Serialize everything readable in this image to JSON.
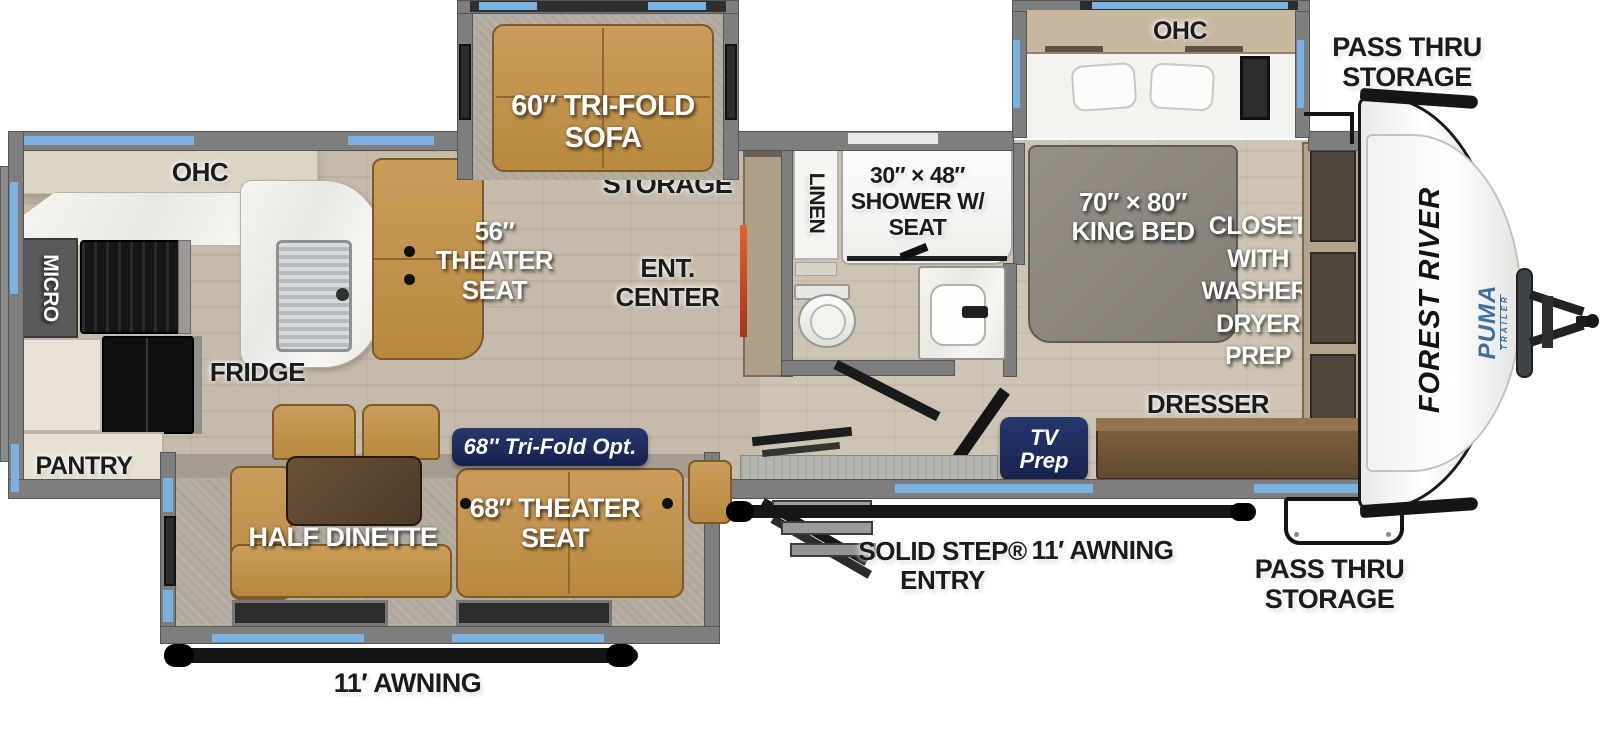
{
  "title": "Forest River Puma travel trailer floor plan",
  "colors": {
    "accent_blue": "#7cb2df",
    "badge_navy": "#1d2c5f",
    "puma_blue": "#3e6f9e",
    "furniture_tan": "#c49a55",
    "wall_gray": "#7e7e7e",
    "floor_tan": "#c6bbaa"
  },
  "front_cap": {
    "brand": "FOREST RIVER",
    "model": "PUMA",
    "model_sub": "TRAILER"
  },
  "exterior": {
    "pass_thru_top": {
      "l1": "PASS THRU",
      "l2": "STORAGE"
    },
    "pass_thru_bottom": {
      "l1": "PASS THRU",
      "l2": "STORAGE"
    },
    "awning_right": "11′ AWNING",
    "awning_bottom": "11′ AWNING",
    "solid_step": {
      "l1": "SOLID STEP®",
      "l2": "ENTRY"
    }
  },
  "living": {
    "sofa_slide": {
      "l1": "60″ TRI-FOLD",
      "l2": "SOFA"
    },
    "storage": "STORAGE",
    "theater_seat": {
      "l1": "56″",
      "l2": "THEATER",
      "l3": "SEAT"
    },
    "ent_center": {
      "l1": "ENT.",
      "l2": "CENTER"
    }
  },
  "kitchen": {
    "ohc": "OHC",
    "micro": "MICRO",
    "fridge": "FRIDGE",
    "pantry": "PANTRY"
  },
  "bath": {
    "linen": "LINEN",
    "shower": {
      "l1": "30″ × 48″",
      "l2": "SHOWER W/",
      "l3": "SEAT"
    }
  },
  "bedroom": {
    "ohc": "OHC",
    "king_bed": {
      "l1": "70″ × 80″",
      "l2": "KING BED"
    },
    "closet": {
      "l1": "CLOSET",
      "l2": "WITH",
      "l3": "WASHER/",
      "l4": "DRYER",
      "l5": "PREP"
    },
    "dresser": "DRESSER",
    "tv_prep": {
      "l1": "TV",
      "l2": "Prep"
    }
  },
  "dinette_slide": {
    "half_dinette": "HALF DINETTE",
    "theater_seat": {
      "l1": "68″ THEATER",
      "l2": "SEAT"
    },
    "tri_fold_opt": "68″ Tri-Fold Opt."
  }
}
